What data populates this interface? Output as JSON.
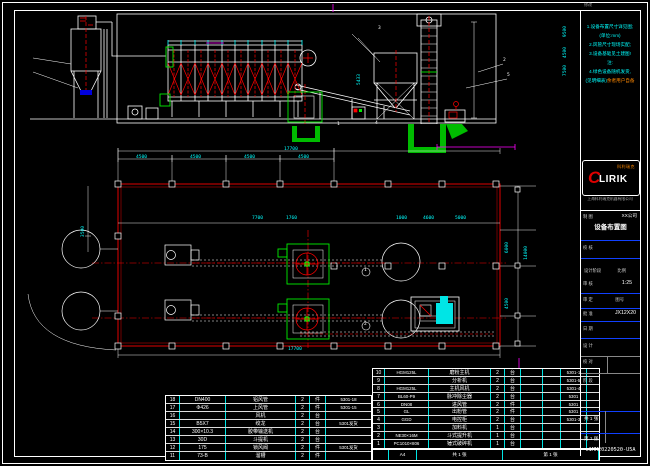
{
  "sheet": {
    "corner_code": "c1MM20220520-U5A"
  },
  "panel": {
    "header_small": "修改",
    "notes": [
      {
        "text": "1.设备布置尺寸详见图;",
        "tail": ""
      },
      {
        "text": "(单位:mm)",
        "tail": ""
      },
      {
        "text": "2.风管尺寸现场实配;",
        "tail": ""
      },
      {
        "text": "3.设备基础见土建图!",
        "tail": ""
      },
      {
        "text": "注:",
        "tail": ""
      },
      {
        "text": "4.绿色设备随机发货,",
        "tail": ""
      },
      {
        "text": "(见明细表)",
        "tail": "余者用户自备"
      }
    ],
    "logo": {
      "c": "C",
      "rest": "LIRIK",
      "cn": "科利瑞克",
      "company": "上海科利瑞克机器有限公司"
    },
    "titleblock": {
      "drawn_label": "制 图",
      "company": "XX公司",
      "title": "设备布置图",
      "checked_label": "校 核",
      "review_label": "审 核",
      "stage_small": "设计阶段",
      "scale_label": "比例",
      "scale": "1:25",
      "approve_label": "审 定",
      "dwgno_label": "图号",
      "dwgno": "JX12X20",
      "ratify_label": "批 准",
      "date_label": "日 期",
      "design_label": "设 计",
      "proof_label": "校 对",
      "stage_label": "阶 段",
      "sheets_total": "共 1 张",
      "sheet_no": "第 1 张"
    }
  },
  "tables": {
    "left_rows": [
      {
        "no": "18",
        "spec": "DN400",
        "name": "铝风管",
        "qty": "2",
        "unit": "件",
        "remark": "5301-18"
      },
      {
        "no": "17",
        "spec": "Φ426",
        "name": "上风管",
        "qty": "2",
        "unit": "件",
        "remark": "5301-15"
      },
      {
        "no": "16",
        "spec": "",
        "name": "风机",
        "qty": "2",
        "unit": "台",
        "remark": ""
      },
      {
        "no": "15",
        "spec": "B5X7",
        "name": "绞龙",
        "qty": "2",
        "unit": "台",
        "remark": "5301发货"
      },
      {
        "no": "14",
        "spec": "300×10.3",
        "name": "胶带输送机",
        "qty": "2",
        "unit": "台",
        "remark": ""
      },
      {
        "no": "13",
        "spec": "30D",
        "name": "斗提机",
        "qty": "2",
        "unit": "台",
        "remark": ""
      },
      {
        "no": "12",
        "spec": "175",
        "name": "锁风阀",
        "qty": "2",
        "unit": "件",
        "remark": "5301发货"
      },
      {
        "no": "11",
        "spec": "73-B",
        "name": "溜槽",
        "qty": "2",
        "unit": "件",
        "remark": ""
      }
    ],
    "right_rows": [
      {
        "no": "10",
        "spec": "HGM125L",
        "name": "磨粉主机",
        "qty": "2",
        "unit": "台",
        "remark": "5301-1"
      },
      {
        "no": "9",
        "spec": "",
        "name": "分析机",
        "qty": "2",
        "unit": "台",
        "remark": "5301-5"
      },
      {
        "no": "8",
        "spec": "HGM125L",
        "name": "主机风机",
        "qty": "2",
        "unit": "台",
        "remark": "5301-4"
      },
      {
        "no": "7",
        "spec": "BL60-P9",
        "name": "脉冲除尘器",
        "qty": "2",
        "unit": "台",
        "remark": "5301"
      },
      {
        "no": "6",
        "spec": "DN08",
        "name": "进风管",
        "qty": "2",
        "unit": "件",
        "remark": "5301"
      },
      {
        "no": "5",
        "spec": "GL",
        "name": "出粉管",
        "qty": "2",
        "unit": "件",
        "remark": "5301"
      },
      {
        "no": "4",
        "spec": "GGD",
        "name": "电控柜",
        "qty": "2",
        "unit": "台",
        "remark": "5301-3"
      },
      {
        "no": "3",
        "spec": "",
        "name": "加料机",
        "qty": "1",
        "unit": "台",
        "remark": ""
      },
      {
        "no": "2",
        "spec": "NE30×16M",
        "name": "斗式提升机",
        "qty": "1",
        "unit": "台",
        "remark": ""
      },
      {
        "no": "1",
        "spec": "PC1010×806",
        "name": "锤式破碎机",
        "qty": "1",
        "unit": "台",
        "remark": ""
      }
    ],
    "strip": {
      "c1": "",
      "size": "A4",
      "total": "共 1 张",
      "no": "第 1 张"
    }
  },
  "labels": [
    {
      "t": "17700",
      "x": 284,
      "y": 148
    },
    {
      "t": "4500",
      "x": 136,
      "y": 156
    },
    {
      "t": "4500",
      "x": 190,
      "y": 156
    },
    {
      "t": "4500",
      "x": 244,
      "y": 156
    },
    {
      "t": "4500",
      "x": 298,
      "y": 156
    },
    {
      "t": "7700",
      "x": 252,
      "y": 217
    },
    {
      "t": "1760",
      "x": 286,
      "y": 217
    },
    {
      "t": "1000",
      "x": 396,
      "y": 217
    },
    {
      "t": "4600",
      "x": 423,
      "y": 217
    },
    {
      "t": "5000",
      "x": 455,
      "y": 217
    },
    {
      "t": "3500",
      "x": 82,
      "y": 226,
      "v": 1
    },
    {
      "t": "6000",
      "x": 506,
      "y": 242,
      "v": 1
    },
    {
      "t": "4500",
      "x": 506,
      "y": 298,
      "v": 1
    },
    {
      "t": "14000",
      "x": 525,
      "y": 246,
      "v": 1
    },
    {
      "t": "17700",
      "x": 288,
      "y": 348
    },
    {
      "t": "9500",
      "x": 564,
      "y": 26,
      "v": 1
    },
    {
      "t": "4500",
      "x": 564,
      "y": 47,
      "v": 1
    },
    {
      "t": "7500",
      "x": 564,
      "y": 65,
      "v": 1
    },
    {
      "t": "5433",
      "x": 358,
      "y": 74,
      "v": 1
    },
    {
      "t": "3",
      "x": 378,
      "y": 27,
      "c": "#ffffff"
    },
    {
      "t": "2",
      "x": 503,
      "y": 59,
      "c": "#ffffff"
    },
    {
      "t": "5",
      "x": 507,
      "y": 74,
      "c": "#ffffff"
    },
    {
      "t": "1",
      "x": 337,
      "y": 123,
      "c": "#ffffff"
    },
    {
      "t": "4",
      "x": 375,
      "y": 122,
      "c": "#ffffff"
    },
    {
      "t": "1",
      "x": 364,
      "y": 269,
      "c": "#ffffff"
    },
    {
      "t": "2",
      "x": 364,
      "y": 323,
      "c": "#ffffff"
    }
  ]
}
